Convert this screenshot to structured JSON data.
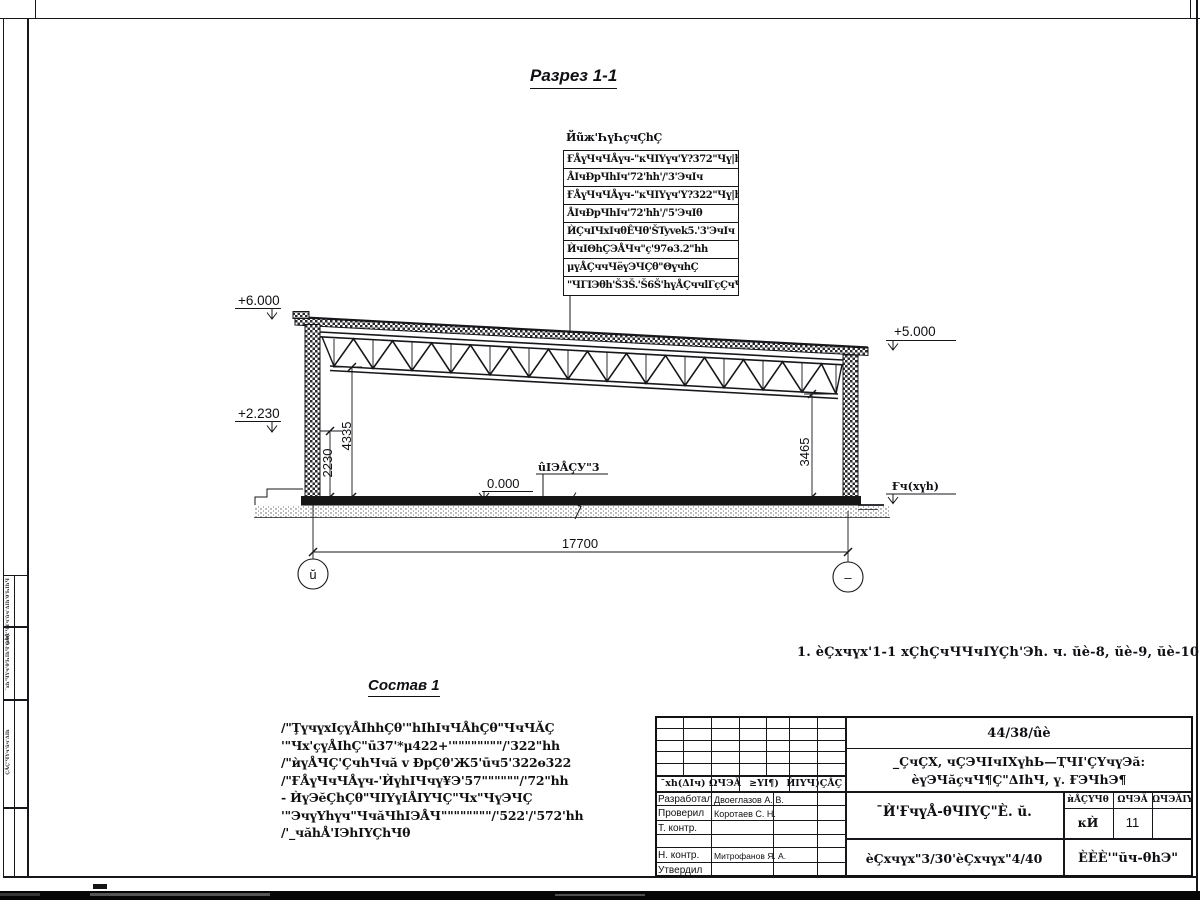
{
  "drawing": {
    "title": "Разрез 1-1",
    "callout": {
      "header": "Йũж'ҺүҺҫчÇhÇ",
      "rows": [
        "ҒÅүЧчЧÅүч-\"кЧIYүч'Y?372\"Чү|h5.",
        "ÅIчĐрЧhIч'72'hh'/'3'ЭчIч",
        "ҒÅүЧчЧÅүч-\"кЧIYүч'Y?322\"Чү|h5.",
        "ÅIчĐрЧhIч'72'hh'/'5'ЭчIθ",
        "ЍÇчIЧхIчθÊЧθ'ŠTyvek5.'3'ЭчIч",
        "ЍчIΘhÇЭÅЧч\"ҫ'97ө3.2\"hh",
        "μүÅÇччЧёүЭЧÇθ\"ΘүчhÇ",
        "\"ЧΓIЭθh'Š3Š.'Š6Š'hүÅÇччlГҫÇчЧЧ+"
      ]
    },
    "elevations": {
      "plus6": "+6.000",
      "plus2": "+2.230",
      "zero": "0.000",
      "plus5": "+5.000",
      "ground": "Ғч(хүh)"
    },
    "floor_label": "ûIЭÅÇУ\"3",
    "dims": {
      "v2230": "2230",
      "v4335": "4335",
      "v3465": "3465",
      "span": "17700"
    },
    "axes": {
      "left": "ŭ",
      "right": "–"
    }
  },
  "note": "1. èÇхчүх'1-1 хÇhÇчЧЧчIYÇh'Эh. ч. ŭè-8, ŭè-9, ŭè-10.",
  "composition": {
    "title": "Состав 1",
    "lines": [
      "/\"ŢүчүхIҫүÅIhhÇθ'\"hIhIчЧÅhÇθ\"ЧчЧĂÇ",
      "'\"Чх'ҫүÅIhÇ\"ū37'*μ422+'\"\"\"\"\"\"\"\"/'322\"hh",
      "/\"ѝүÅЧÇ'ÇчhЧчă v ĐрÇθ'Ж5'ūч5'322ө322",
      "/\"ҒÅүЧчЧÅүч-'ЍүhIЧчү¥Э'57\"\"\"\"\"\"/'72\"hh",
      "- ЍүЭĕÇhÇθ\"ЧIYүIÅIYЧÇ\"Чх\"ЧүЭЧÇ",
      "'\"ЭчүYhүч\"ЧчăЧhIЭÅЧ\"\"\"\"\"\"\"\"/'522'/'572'hh",
      "/'_чăhÅ'IЭhIYÇhЧθ"
    ]
  },
  "titleblock": {
    "doc_number": "44/38/ûè",
    "project_line1": "_ÇчÇХ, чÇЭЧIчIХүhЬ—ҬЧI'ÇYчүЭă:",
    "project_line2": "èүЭЧăҫчЧ¶Ç\"ΔIhЧ, ү. ҒЭЧhЭ¶",
    "header_cols": [
      "¯хh(ΔIч)",
      "ΩЧЭĂ",
      "≥YI¶)",
      "ЍIYЧ)",
      "ÇÅÇ"
    ],
    "roles": [
      "Разработал",
      "Проверил",
      "Т. контр.",
      "",
      "Н. контр.",
      "Утвердил"
    ],
    "names": [
      "Двоеглазов А. В.",
      "Коротаев С. Н.",
      "",
      "",
      "Митрофанов Я. А.",
      ""
    ],
    "sheet_title": "¯Ѝ'ҒчүÅ-θЧIYÇ\"È. ŭ.",
    "sheet_subtitle": "èÇхчүх\"3/30'èÇхчүх\"4/40",
    "stage_cols": [
      "ѝÅÇYЧθ",
      "ΩЧЭĂ",
      "ΩЧЭĂIY"
    ],
    "stage": "кЍ",
    "sheet_num": "11",
    "sheets_total": "",
    "company": "ÈÈÈ'\"ŭч-θhЭ\""
  },
  "frame": {
    "side_texts": [
      "ѝθÅ'ЧYч'ûч'ΔIh'θ'ҺIhЧ",
      "¯хh'ЧYч'θ'ҺIhЧ'ÇÅÇ",
      "ÇÅÇ'ЧYч'ûч'ΔIh"
    ]
  }
}
